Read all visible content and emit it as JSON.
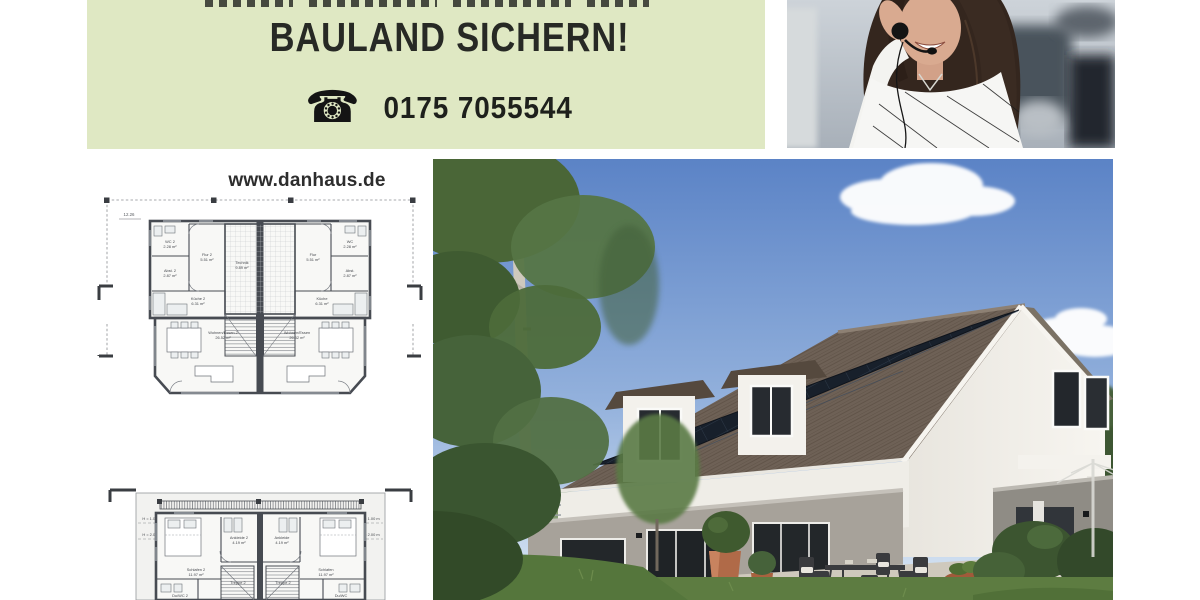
{
  "banner": {
    "headline": "BAULAND SICHERN!",
    "phone_number": "0175 7055544",
    "phone_icon": "rotary-phone-icon",
    "background_color": "#dfe8c3",
    "text_color": "#272925"
  },
  "website_label": "www.danhaus.de",
  "floorplan_ground": {
    "dimension_top": "12.26",
    "rooms": [
      {
        "label": "WC 2",
        "area": "2.28 m²"
      },
      {
        "label": "Flur 2",
        "area": "5.51 m²"
      },
      {
        "label": "Technik",
        "area": "9.89 m²"
      },
      {
        "label": "Flur",
        "area": "5.51 m²"
      },
      {
        "label": "WC",
        "area": "2.28 m²"
      },
      {
        "label": "Abst. 2",
        "area": "2.87 m²"
      },
      {
        "label": "Abst.",
        "area": "2.87 m²"
      },
      {
        "label": "Küche 2",
        "area": "6.31 m²"
      },
      {
        "label": "Küche",
        "area": "6.31 m²"
      },
      {
        "label": "Wohnen/Essen 2",
        "area": "26.52 m²"
      },
      {
        "label": "Wohnen/Essen",
        "area": "26.52 m²"
      }
    ]
  },
  "floorplan_upper": {
    "height_mark_1": "H = 1.00 m",
    "height_mark_2": "H = 2.00 m",
    "rooms": [
      {
        "label": "Schlafen 2",
        "area": "11.97 m²"
      },
      {
        "label": "Ankleide 2",
        "area": "4.19 m²"
      },
      {
        "label": "Ankleide",
        "area": "4.19 m²"
      },
      {
        "label": "Schlafen",
        "area": "11.97 m²"
      },
      {
        "label": "Treppe 2"
      },
      {
        "label": "Treppe"
      },
      {
        "label": "Du/WC 2"
      },
      {
        "label": "Du/WC"
      }
    ]
  },
  "photos": {
    "agent_photo": "smiling service agent with telephone headset",
    "house_photo": "modern duplex house with solar roof, terrace and garden"
  }
}
